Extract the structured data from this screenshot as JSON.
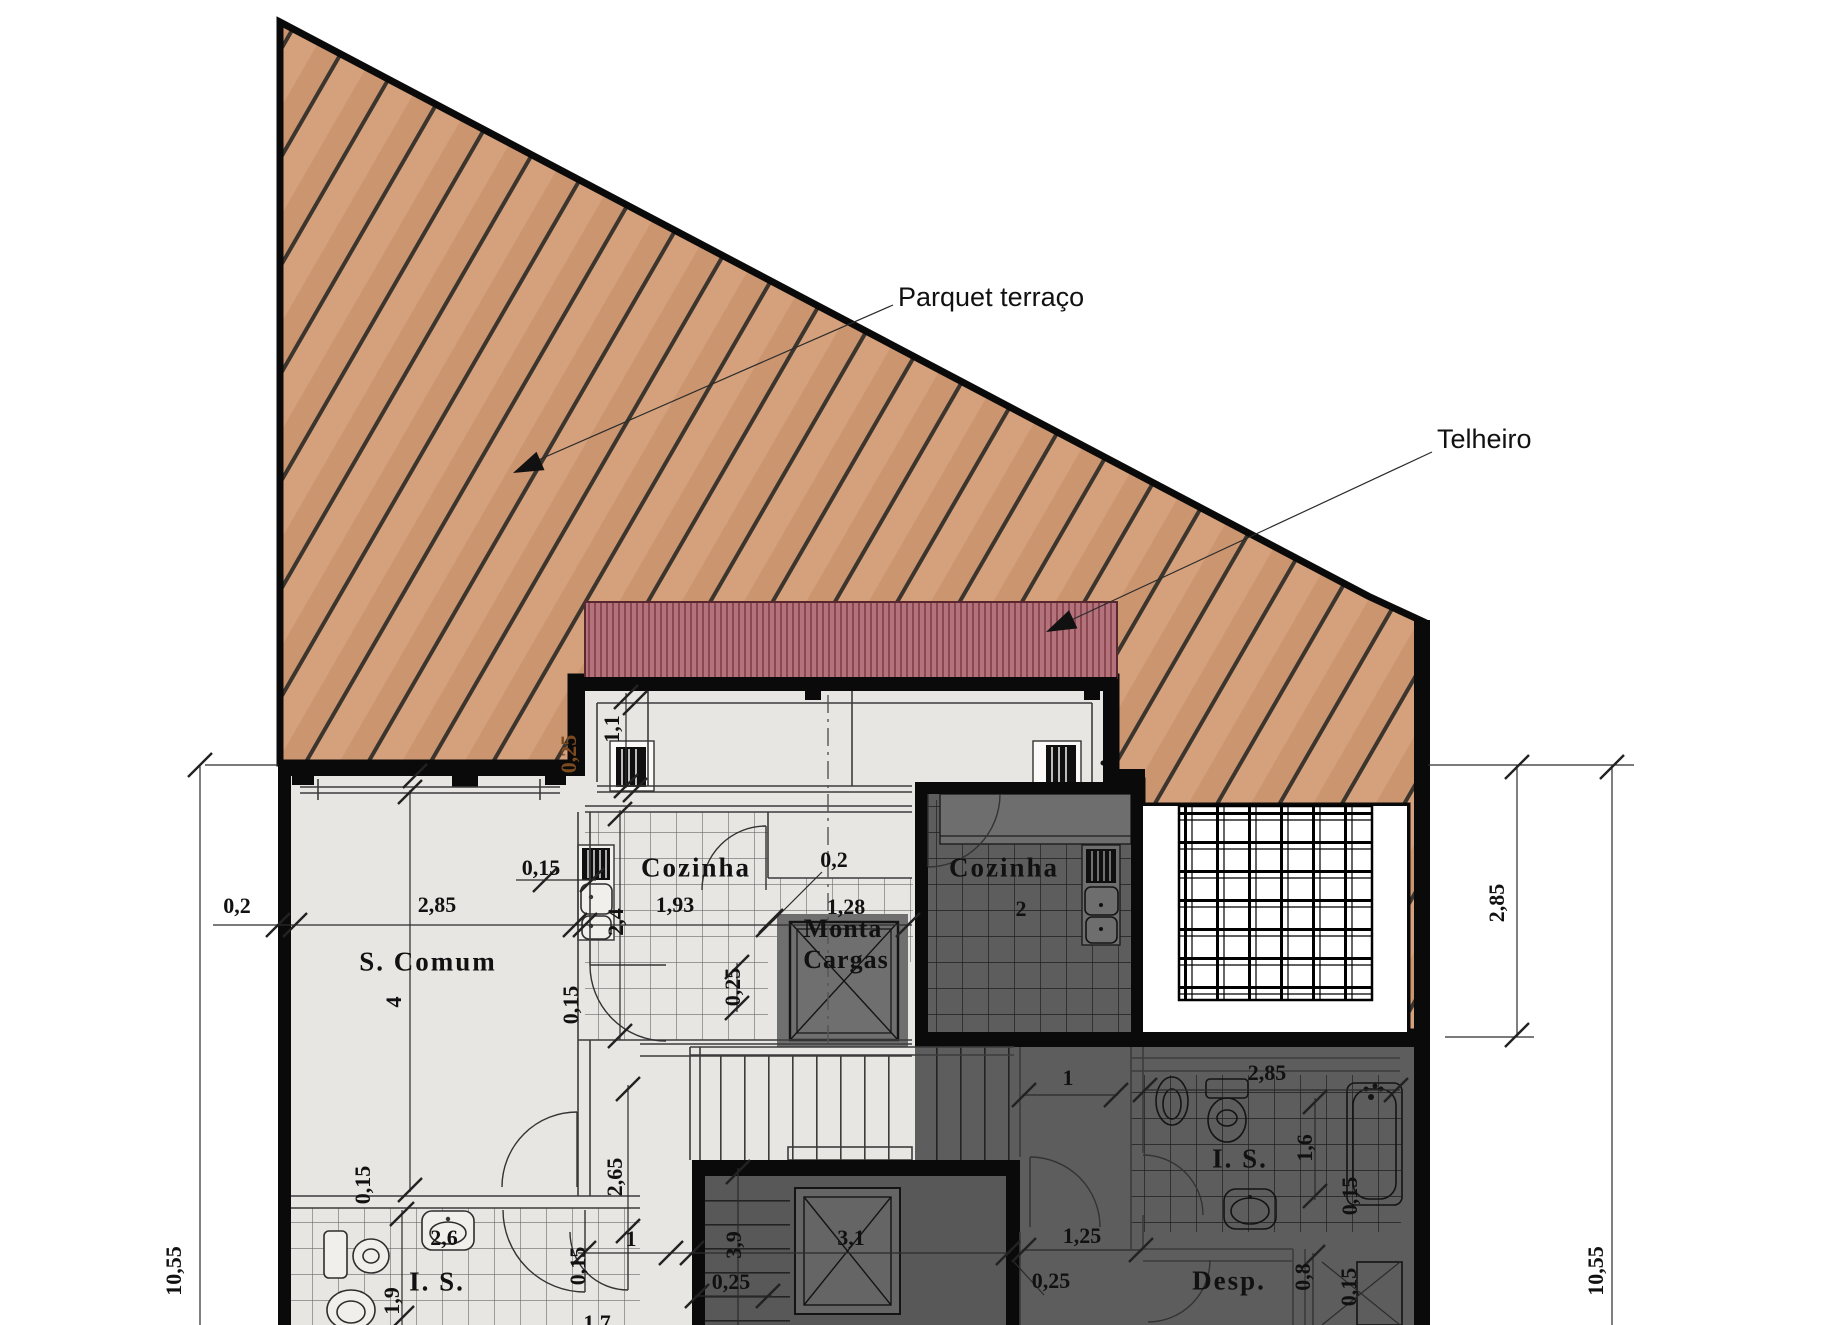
{
  "annotations": {
    "parquet": "Parquet terraço",
    "telheiro": "Telheiro"
  },
  "rooms": {
    "s_comum": "S. Comum",
    "s_comum_num": "4",
    "cozinha_left": "Cozinha",
    "cozinha_right": "Cozinha",
    "cozinha_right_num": "2",
    "monta_line1": "Monta",
    "monta_line2": "Cargas",
    "is_left": "I. S.",
    "is_right": "I. S.",
    "desp": "Desp."
  },
  "dims": {
    "site_0_2": "0,2",
    "site_2_85": "2,85",
    "site_10_55_left": "10,55",
    "site_2_85_right": "2,85",
    "site_10_55_right": "10,55",
    "k_0_15": "0,15",
    "k_1_93": "1,93",
    "k_0_2": "0,2",
    "k_1_28": "1,28",
    "k_1_1": "1,1",
    "k_2_4": "2,4",
    "k_0_25": "0,25",
    "k_0_15v": "0,15",
    "parapet_0_25": "0,25",
    "sc_0_15": "0,15",
    "is_2_6": "2,6",
    "is_1_9": "1,9",
    "is_0_15": "0,15",
    "st_2_65": "2,65",
    "st_1": "1",
    "st_3_9": "3,9",
    "st_0_25": "0,25",
    "st_3_1": "3,1",
    "st_1_7": "1,7",
    "r_1": "1",
    "r_2_85": "2,85",
    "r_1_6": "1,6",
    "r_0_15a": "0,15",
    "r_1_25": "1,25",
    "r_0_25": "0,25",
    "r_0_8": "0,8",
    "r_0_15b": "0,15"
  },
  "colors": {
    "wood_base": "#d5a17c",
    "wood_dark": "#cb9570",
    "wood_line": "#3b352e",
    "roof_base": "#b3737c",
    "roof_stripe": "#8c4751",
    "interior_light": "#e8e6e3",
    "interior_dark": "#5d5d5d",
    "wall": "#0a0a0a",
    "label_text": "#111111",
    "parapet_label": "#7c4a1e"
  }
}
